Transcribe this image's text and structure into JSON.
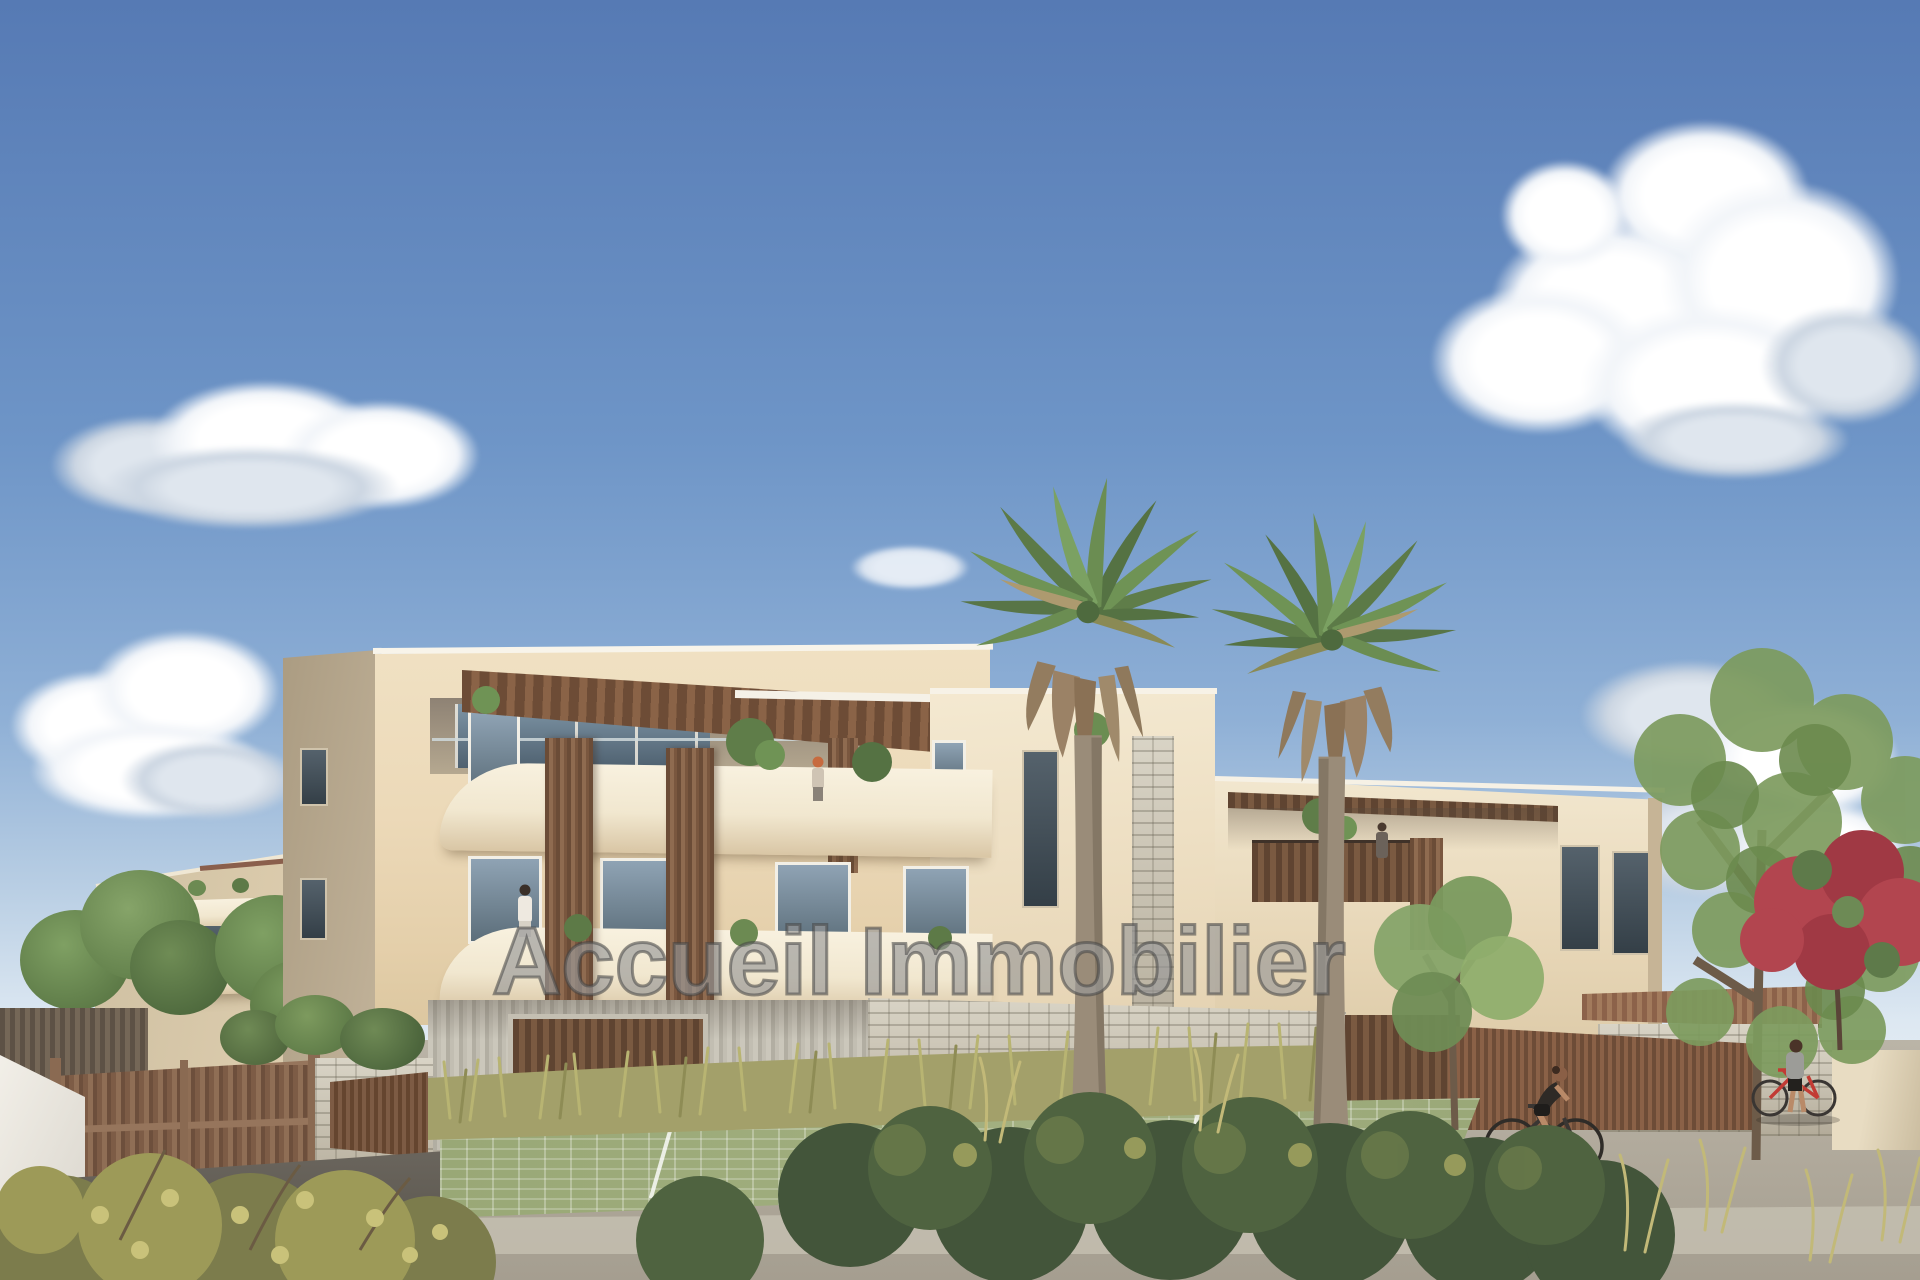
{
  "watermark": {
    "text": "Accueil Immobilier",
    "style": "translucent outlined gray overlay text centered on image"
  },
  "scene": {
    "type": "3D architectural rendering (real-estate visual)",
    "subject": "Modern cream three-storey apartment residence with rounded white balconies, timber-slat privacy screens and pergolas, two tall fan palms in front, landscaped forecourt with permeable grass pavers, stone walls, timber gate, cyclists and pedestrians under a blue sky with cumulus clouds",
    "sky": {
      "top_color": "#567ab4",
      "mid_color": "#8fb0d6",
      "horizon_color": "#eef3f7",
      "clouds": [
        "large cumulus top right",
        "elongated cloud mid left",
        "bright horizon clouds far left",
        "soft horizon clouds right",
        "small wisp near palms"
      ]
    },
    "building": {
      "storeys": 3,
      "facade_color": "#ecdcba",
      "features": [
        "rounded white balcony parapets",
        "brown pergola roof over top terrace",
        "vertical timber slat screens",
        "stone-clad pillar",
        "gray slat ground floor with timber garage door",
        "stone base walls",
        "tiled carport roof at right"
      ]
    },
    "landscape": {
      "fan_palms": 2,
      "trees": [
        "green trees behind left gate",
        "small tree in front of right wing",
        "large airy tree far right",
        "red flowering tree far right"
      ],
      "ground": [
        "green grass-paver parking with white bay lines",
        "light gray road",
        "dark asphalt driveway left",
        "olive grasses along base",
        "dark green foreground shrubs",
        "yellow-green shrub bottom left"
      ]
    },
    "people": [
      {
        "label": "woman with red hair on roof terrace"
      },
      {
        "label": "woman in white on second-floor balcony"
      },
      {
        "label": "small figure on left-wing window"
      },
      {
        "label": "person on right-wing balcony"
      },
      {
        "label": "woman riding bicycle on road"
      },
      {
        "label": "person walking beside red bicycle at right"
      }
    ]
  },
  "palette": {
    "facade_sunlit": "#ecdcba",
    "facade_shaded": "#b3a489",
    "parapet_white": "#f4ecd9",
    "pergola_brown": "#6d4c36",
    "timber_slat": "#8f6b50",
    "stone": "#c8c2b2",
    "ground_slat_gray": "#c0bcb0",
    "garage_brown": "#6f5440",
    "road": "#b3ada0",
    "asphalt": "#5f5a52",
    "paver_green": "#9dab7a",
    "grass_olive": "#a8a468",
    "shrub_dark": "#43553a",
    "palm_green": "#6f9355",
    "palm_skirt": "#9b8266",
    "red_flowers": "#b2454f",
    "window_glass": "#5c6e7a",
    "cloud_white": "#ffffff"
  }
}
